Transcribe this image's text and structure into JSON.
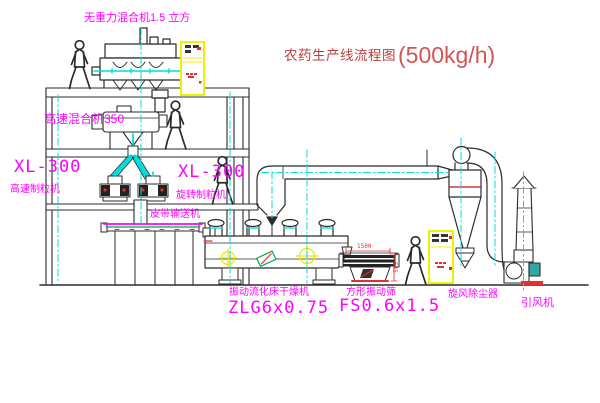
{
  "title": {
    "name": "农药生产线流程图",
    "capacity": "(500kg/h)"
  },
  "labels": {
    "gravity_mixer": "无重力混合机1.5 立方",
    "high_speed_mixer": "高速混合机350",
    "granulator_left_model": "XL-300",
    "granulator_left_name": "高速制粒机",
    "granulator_center_model": "XL-300",
    "granulator_center_name": "旋转制粒机",
    "belt_conveyor": "皮带输送机",
    "dryer_name": "振动流化床干燥机",
    "dryer_model": "ZLG6x0.75",
    "screen_name": "方形振动筛",
    "screen_model": "FS0.6x1.5",
    "dust_collector": "旋风除尘器",
    "fan": "引风机"
  },
  "dimensions": {
    "screen_length": "1500",
    "screen_height": "545"
  },
  "icons": {
    "worker": "human-figure-icon",
    "crosshair": "target-crosshair-icon",
    "cabinet": "electric-control-cabinet"
  },
  "colors": {
    "line": "#2b2b2b",
    "centerline": "#00dede",
    "label": "#ff00ff",
    "title_text": "#bc3c3c",
    "cabinet": "#f0f000",
    "dimension": "#e03030",
    "belt": "#ff00ff",
    "belt_accent": "#00a550"
  }
}
